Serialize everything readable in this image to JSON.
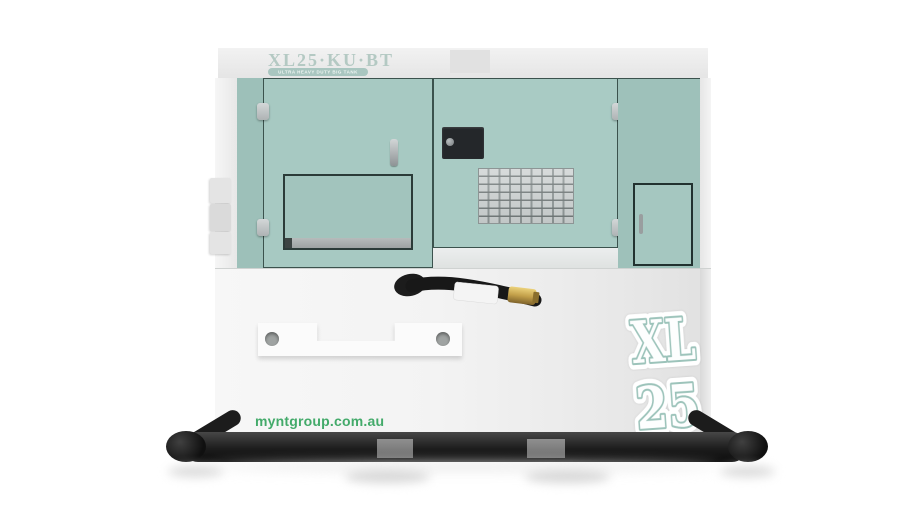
{
  "product": {
    "model_label": "XL25·KU·BT",
    "model_sub_label": "ULTRA HEAVY DUTY BIG TANK",
    "logo_top": "XL",
    "logo_bottom": "25",
    "website": "myntgroup.com.au"
  },
  "colors": {
    "panel_teal": "#a7c9c2",
    "panel_teal_dark": "#9dc0b9",
    "body_white": "#f4f4f4",
    "roof_band_gray": "#ededed",
    "door_edge": "#3b524d",
    "skid_black": "#1d1d1d",
    "brand_green": "#43aa6a",
    "logo_outline_teal": "#9cc3ba",
    "brass_gold": "#c9a94f",
    "model_label_text": "#b4c9c3"
  }
}
